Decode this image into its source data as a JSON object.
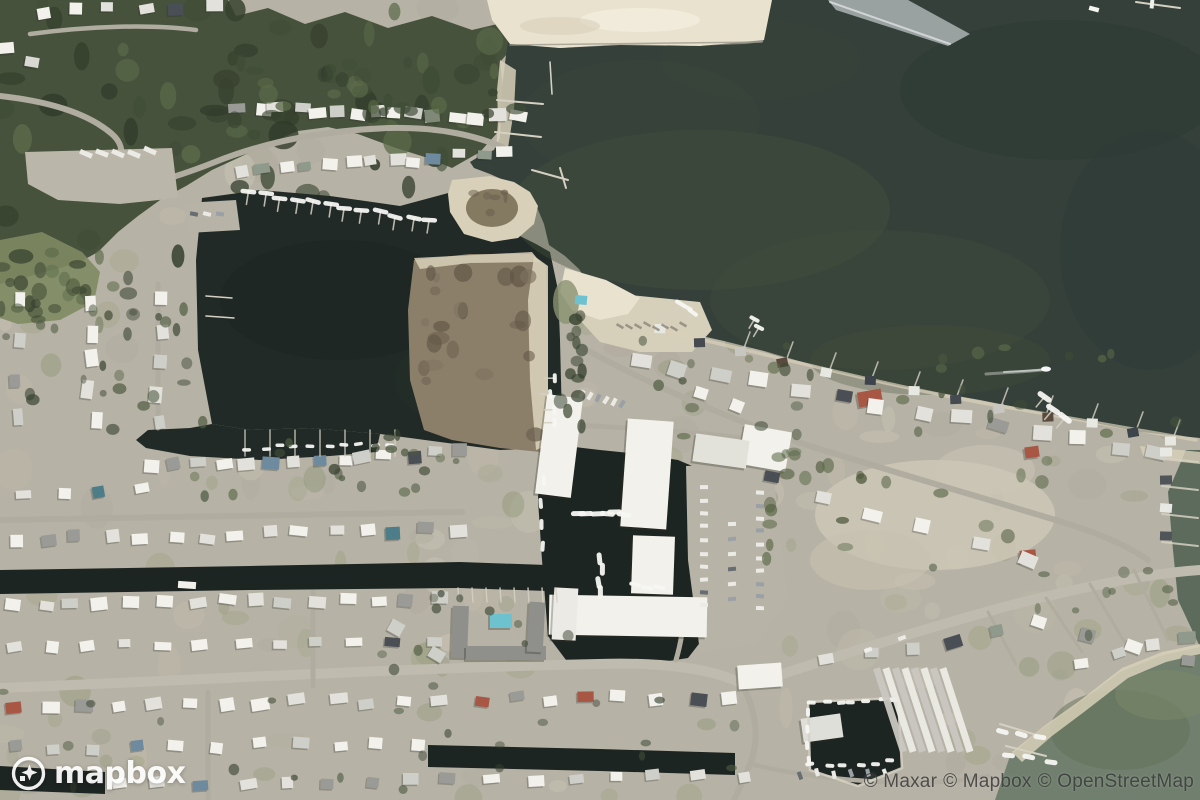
{
  "map": {
    "view_type": "satellite",
    "logo": {
      "text": "mapbox"
    },
    "attribution": {
      "maxar": "© Maxar",
      "mapbox": "© Mapbox",
      "osm": "© OpenStreetMap"
    },
    "colors": {
      "land": "#b6b2a5",
      "land_light": "#cfc9b8",
      "lawn": "#8a9270",
      "forest": "#46523c",
      "forest_dark": "#36412e",
      "forest_light": "#5c6b4a",
      "marsh_green": "#7e8a62",
      "bay": "#344039",
      "bay_light": "#46523f",
      "bay_dark": "#2c3834",
      "lagoon": "#212a26",
      "canal": "#1d2522",
      "green_water": "#71806e",
      "green_water_deep": "#5d6b5c",
      "sand": "#e9e2cf",
      "sand_dim": "#d8d0b9",
      "road": "#b0ac9f",
      "road_major": "#bfbbae",
      "marsh": "#8b7f6a",
      "marsh_dark": "#6e6250",
      "roof_white": "#f2f1ec",
      "roof_gray": "#9a9a96",
      "roof_dark": "#4a4f55",
      "roof_teal": "#4e7d8a",
      "roof_red": "#a85744",
      "pool": "#6ec1ce",
      "dock": "#d5d0c2",
      "logo_color": "#ffffff",
      "attribution_color": "#343434"
    }
  }
}
